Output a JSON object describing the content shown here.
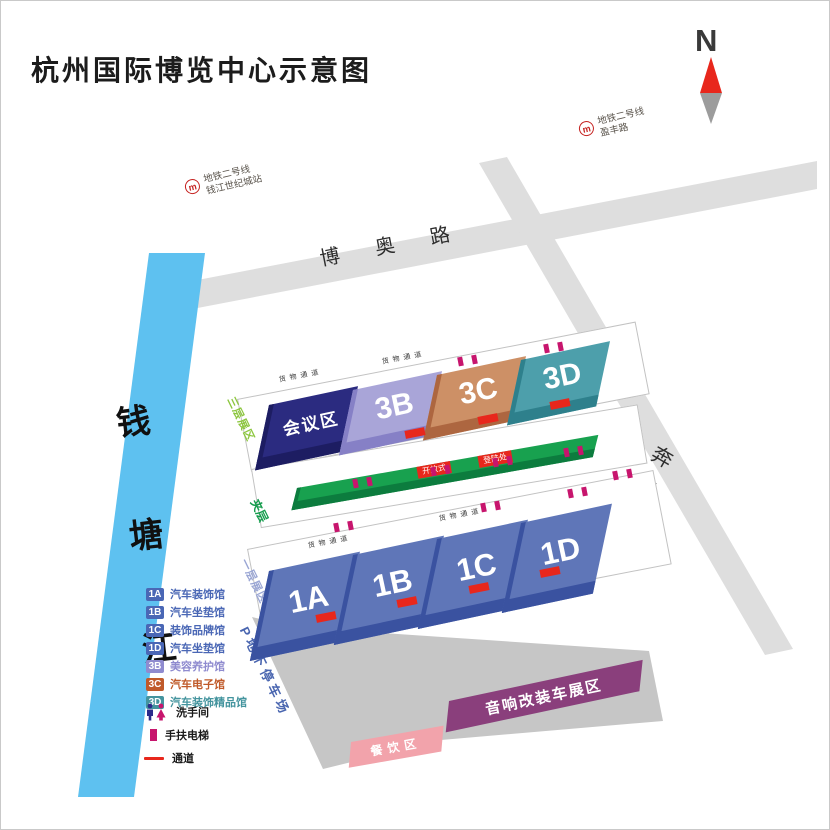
{
  "title": "杭州国际博览中心示意图",
  "compass": {
    "label": "N"
  },
  "metro_stations": [
    {
      "line": "地铁二号线",
      "station": "盈丰路"
    },
    {
      "line": "地铁二号线",
      "station": "钱江世纪城站"
    }
  ],
  "roads": {
    "boao": "博奥路",
    "benjing": "奔竞大道"
  },
  "river": {
    "name": "钱塘江"
  },
  "floors": {
    "third": {
      "edge_label": "三层展区",
      "cargo": "货物通道",
      "halls": [
        {
          "code": "会议区",
          "color": "#2b2b80",
          "side": "#1d1d62"
        },
        {
          "code": "3B",
          "color": "#a9a5d8",
          "side": "#8680c6"
        },
        {
          "code": "3C",
          "color": "#cd9066",
          "side": "#ad6640"
        },
        {
          "code": "3D",
          "color": "#4d9fab",
          "side": "#2e808c"
        }
      ]
    },
    "mezzanine": {
      "edge_label": "夹层",
      "color": "#18a14f",
      "tags": [
        "开放式",
        "登陆处"
      ]
    },
    "first": {
      "edge_label": "一层展区",
      "cargo": "货物通道",
      "halls": [
        {
          "code": "1A",
          "color": "#5f76b8",
          "side": "#3a52a0"
        },
        {
          "code": "1B",
          "color": "#5f76b8",
          "side": "#3a52a0"
        },
        {
          "code": "1C",
          "color": "#5f76b8",
          "side": "#3a52a0"
        },
        {
          "code": "1D",
          "color": "#5f76b8",
          "side": "#3a52a0"
        }
      ]
    },
    "parking": "P地下停车场"
  },
  "areas": {
    "audio": {
      "label": "音响改装车展区",
      "color": "#8a3f7c"
    },
    "dining": {
      "label": "餐饮区",
      "color": "#f2a3ab"
    }
  },
  "legend": {
    "halls": [
      {
        "code": "1A",
        "name": "汽车装饰馆",
        "color": "#4a67b5"
      },
      {
        "code": "1B",
        "name": "汽车坐垫馆",
        "color": "#4a67b5"
      },
      {
        "code": "1C",
        "name": "装饰品牌馆",
        "color": "#4a67b5"
      },
      {
        "code": "1D",
        "name": "汽车坐垫馆",
        "color": "#4a67b5"
      },
      {
        "code": "3B",
        "name": "美容养护馆",
        "color": "#8f8bcf"
      },
      {
        "code": "3C",
        "name": "汽车电子馆",
        "color": "#c05a2a"
      },
      {
        "code": "3D",
        "name": "汽车装饰精品馆",
        "color": "#44949e"
      }
    ],
    "symbols": [
      {
        "name": "洗手间"
      },
      {
        "name": "手扶电梯"
      },
      {
        "name": "通道"
      }
    ]
  }
}
